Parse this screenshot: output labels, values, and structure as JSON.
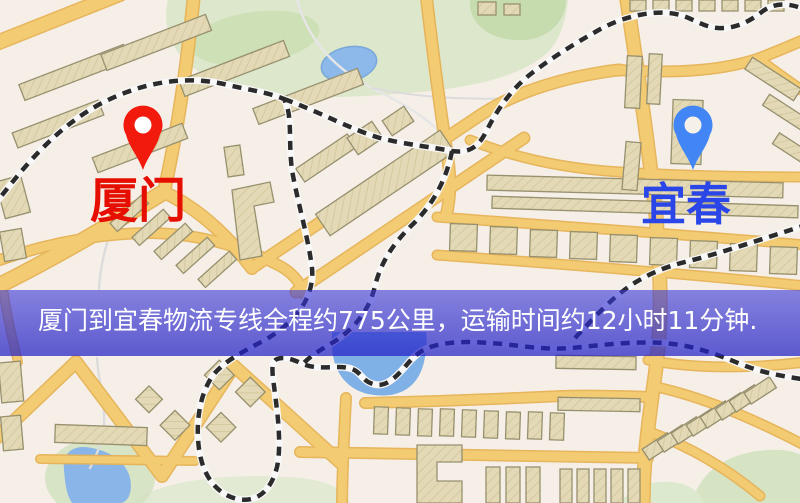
{
  "map": {
    "markers": [
      {
        "id": "origin",
        "label": "厦门",
        "pin_color": "#f2190d",
        "pin_hole_color": "#ffffff",
        "label_color": "#e60e00"
      },
      {
        "id": "destination",
        "label": "宜春",
        "pin_color": "#4285f4",
        "pin_hole_color": "#f6f1e8",
        "label_color": "#2b46e8"
      }
    ],
    "colors": {
      "background": "#f5efe7",
      "road": "#f3cb72",
      "road_casing": "#e6b255",
      "building": "#e3d9b6",
      "building_outline": "#97906f",
      "park": "#dce7cb",
      "park_dark": "#ccdfb4",
      "water": "#8cb8ea",
      "railway": "#2b2b2b",
      "railway_casing": "#f8f8f8",
      "stream": "#dcdcdc"
    }
  },
  "banner": {
    "text": "厦门到宜春物流专线全程约775公里，运输时间约12小时11分钟.",
    "background_color": "#2b29cd",
    "text_color": "#ffffff"
  }
}
